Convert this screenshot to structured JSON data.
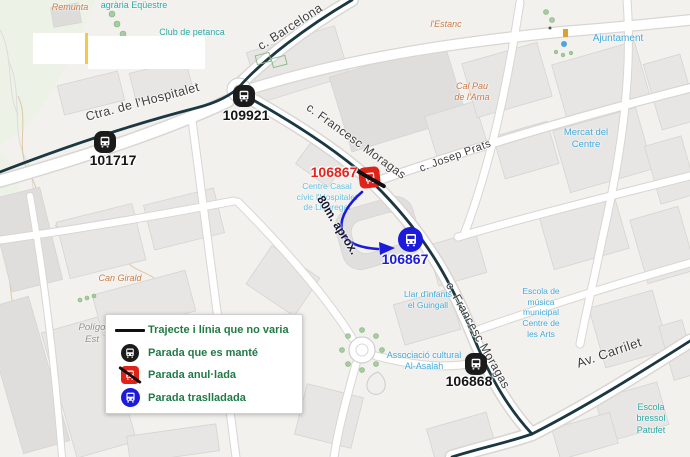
{
  "map": {
    "streets": [
      {
        "name": "Ctra. de l'Hospitalet"
      },
      {
        "name": "c. Barcelona"
      },
      {
        "name": "c. Francesc Moragas"
      },
      {
        "name": "c. Josep Prats"
      },
      {
        "name": "c. Francesc Moragas"
      },
      {
        "name": "Av. Carrilet"
      }
    ],
    "pois": [
      {
        "text": "Remunta"
      },
      {
        "text": "agrària Eqüestre"
      },
      {
        "text": "Club de petanca"
      },
      {
        "text": "l'Estanc"
      },
      {
        "text": "Cal Pau\nde l'Arna"
      },
      {
        "text": "Ajuntament"
      },
      {
        "text": "Mercat del\nCentre"
      },
      {
        "text": "Centre Casal\ncívic l'Hospitalet\nde Llobregat"
      },
      {
        "text": "Llar d'infants\nel Guingall"
      },
      {
        "text": "Associació cultural\nAl-Asalah"
      },
      {
        "text": "Escola de\nmúsica\nmunicipal\nCentre de\nles Arts"
      },
      {
        "text": "Escola bressol\nPatufet"
      },
      {
        "text": "Can Girald"
      },
      {
        "text": "Polígo\nEst"
      }
    ],
    "stops": [
      {
        "code": "109921",
        "status": "kept"
      },
      {
        "code": "101717",
        "status": "kept"
      },
      {
        "code": "106867",
        "status": "cancelled"
      },
      {
        "code": "106867",
        "status": "moved"
      },
      {
        "code": "106868",
        "status": "kept"
      }
    ],
    "annotation": {
      "distance": "80m. aprox."
    }
  },
  "legend": {
    "items": [
      {
        "icon": "route-line",
        "label": "Trajecte i línia que no varia"
      },
      {
        "icon": "kept-stop",
        "label": "Parada que es manté"
      },
      {
        "icon": "cancelled-stop",
        "label": "Parada anul·lada"
      },
      {
        "icon": "moved-stop",
        "label": "Parada traslladada"
      }
    ]
  },
  "colors": {
    "route_line": "#1a3742",
    "stop_kept": "#1b1b1b",
    "stop_cancelled": "#e02318",
    "stop_moved": "#1b1bd9",
    "label_red": "#e8221c",
    "label_blue": "#1b1bd9",
    "legend_text": "#217a46"
  }
}
